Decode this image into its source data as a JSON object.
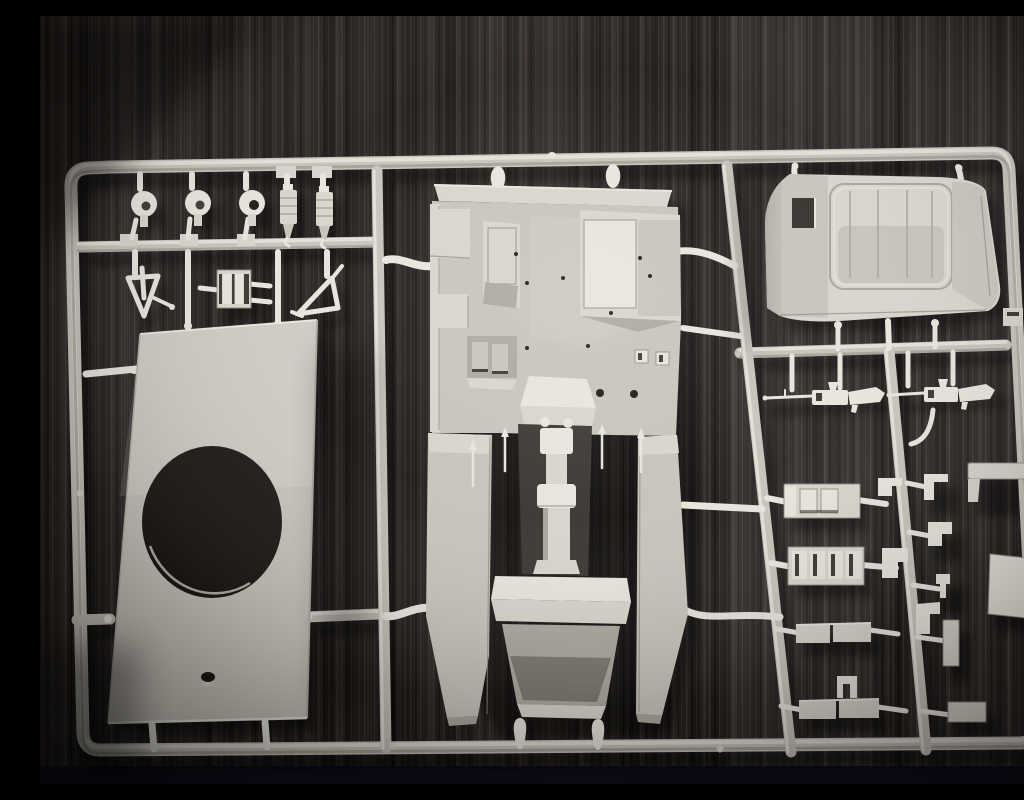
{
  "scene": {
    "type": "photograph",
    "description": "Close-up photo of a light grey injection-moulded model kit sprue (parts tree) lying on a dark wood-grain surface. The rectangular runner frame holds a large vehicle hull tub in the centre, an engine hood at top right, a flat floor panel with a large round opening at left, small clamps and brackets at top left, and two machine guns, seat boxes, plates and small fittings on the right.",
    "background": "dark brown-black wood with fine vertical grain, darker vignetted corners, near-black strip along the bottom edge",
    "visible_text": ""
  },
  "colors": {
    "wood-base": "#262220",
    "wood-dark": "#15130f",
    "wood-light": "#4e463e",
    "bottom-strip": "#100e1c",
    "sprue-bright": "#e7e4dc",
    "sprue-light": "#d8d4cb",
    "sprue-mid": "#c7c3ba",
    "sprue-shade": "#aca89f",
    "sprue-deep": "#8f8b82",
    "recess-dark": "#3a3631",
    "hole-dark": "#1b1815",
    "shadow": "#000000"
  },
  "sprue": {
    "material": "light grey polystyrene",
    "frame": {
      "shape": "rounded rectangle with internal runners",
      "vertical_runners": 3,
      "horizontal_runners": 3
    },
    "parts": [
      {
        "name": "clamp-hook",
        "count": 3,
        "area": "top-left"
      },
      {
        "name": "ribbed-cylinder",
        "count": 2,
        "area": "top-left"
      },
      {
        "name": "v-shaped-bracket",
        "count": 2,
        "area": "upper-left"
      },
      {
        "name": "slotted-frame-block",
        "count": 1,
        "area": "upper-left"
      },
      {
        "name": "floor-panel-with-round-opening",
        "count": 1,
        "area": "left"
      },
      {
        "name": "hull-tub-with-gun-pedestal",
        "count": 1,
        "area": "center"
      },
      {
        "name": "engine-hood-with-ribbed-panel",
        "count": 1,
        "area": "top-right"
      },
      {
        "name": "machine-gun",
        "count": 2,
        "area": "right"
      },
      {
        "name": "j-hook",
        "count": 1,
        "area": "right"
      },
      {
        "name": "seat-box",
        "count": 2,
        "area": "right-middle"
      },
      {
        "name": "flat-plate-pair",
        "count": 2,
        "area": "right-middle"
      },
      {
        "name": "small-bracket-or-clip",
        "count": 8,
        "area": "far-right"
      },
      {
        "name": "flat-rectangular-panel",
        "count": 1,
        "area": "far-right-edge"
      }
    ]
  }
}
